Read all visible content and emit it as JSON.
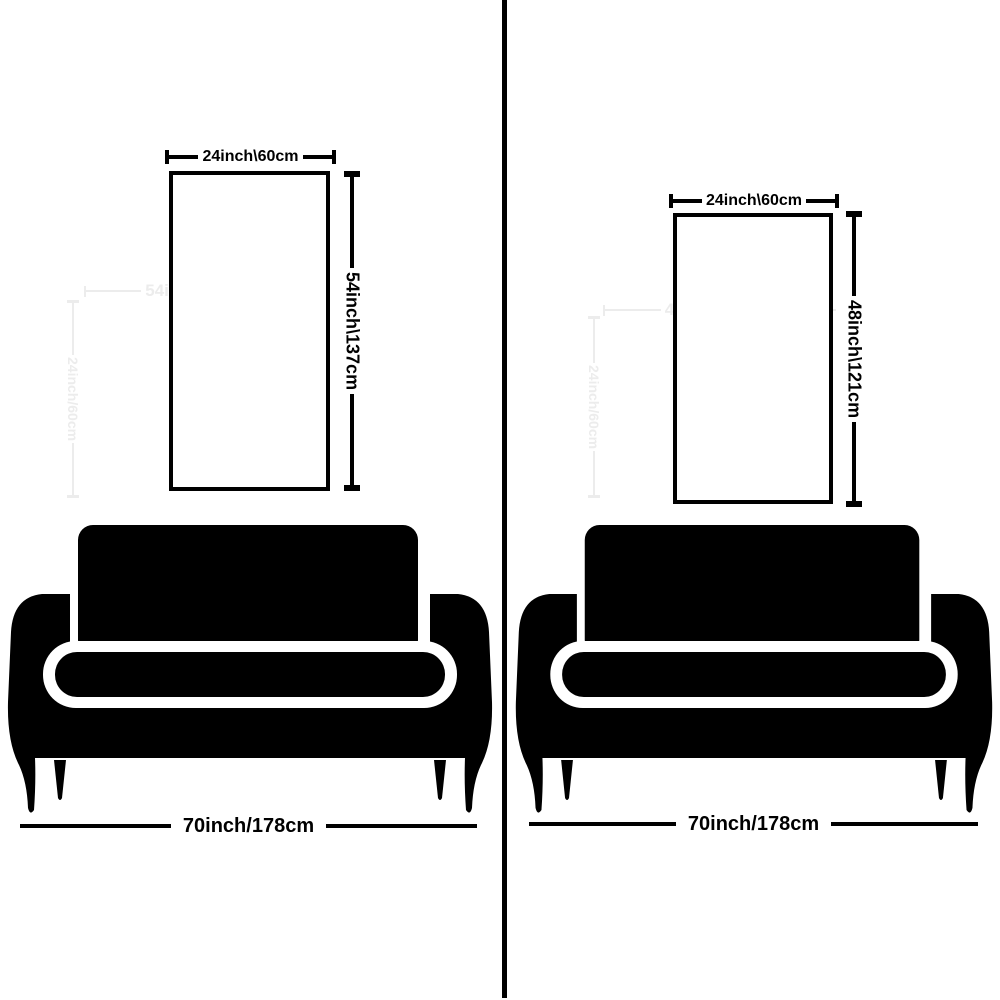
{
  "colors": {
    "ink": "#000000",
    "bg": "#ffffff",
    "ghost": "#ececec"
  },
  "panels": [
    {
      "side": "left",
      "poster_width_label": "24inch\\60cm",
      "poster_height_label": "54inch\\137cm",
      "sofa_width_label": "70inch/178cm",
      "ghost_horizontal_label": "54inch/137cm",
      "ghost_vertical_label": "24inch/60cm"
    },
    {
      "side": "right",
      "poster_width_label": "24inch\\60cm",
      "poster_height_label": "48inch\\121cm",
      "sofa_width_label": "70inch/178cm",
      "ghost_horizontal_label": "48inch/121cm",
      "ghost_vertical_label": "24inch/60cm"
    }
  ]
}
